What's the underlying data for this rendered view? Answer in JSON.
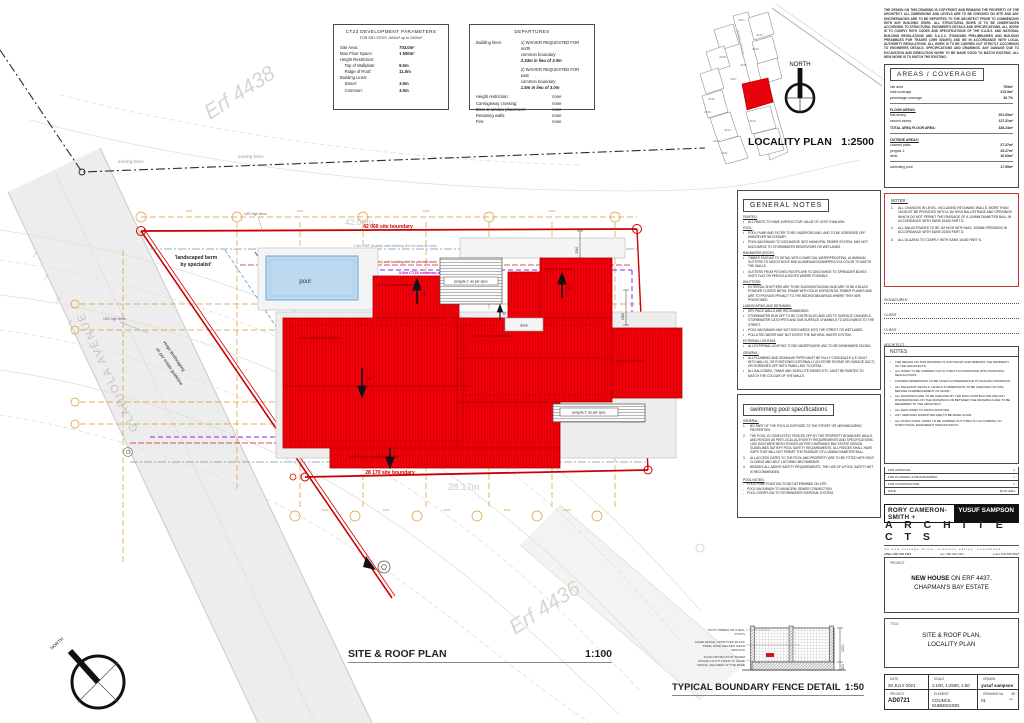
{
  "colors": {
    "roof_red": "#f2000a",
    "boundary_red": "#cc0000",
    "orange": "#d89a33",
    "purple": "#8a2bd6",
    "magenta": "#bb00bb",
    "blue_dash": "#4aa3d8",
    "pool_blue": "#bdd9ef",
    "street_gray": "#ededed",
    "notes_border": "#c0392b"
  },
  "tables": {
    "ct23": {
      "title": "CT23 DEVELOPMENT PARAMETERS",
      "subtitle": "FOR SR1 SITES >600m² up to 1000m²",
      "rows": [
        {
          "l": "Site Area:",
          "v": "703.0m²"
        },
        {
          "l": "Max Floor Space:",
          "v": "1 500m²"
        },
        {
          "l": "",
          "v": ""
        },
        {
          "l": "Height Restriction:",
          "v": ""
        },
        {
          "l": "    Top of Wallplate:",
          "v": "9.0m"
        },
        {
          "l": "    Ridge of Roof:",
          "v": "11.0m"
        },
        {
          "l": "Building Lines:",
          "v": ""
        },
        {
          "l": "    Street:",
          "v": "3.5m"
        },
        {
          "l": "    Common:",
          "v": "3.0m"
        }
      ]
    },
    "departures": {
      "title": "DEPARTURES",
      "bl_label": "Building lines:",
      "w1_lines": [
        "1) WAIVER REQUESTED FOR north",
        "common boundary"
      ],
      "w1_bold": "2.34m in lieu of 3.0m",
      "w2_lines": [
        "2) WAIVER REQUESTED FOR east",
        "common boundary"
      ],
      "w2_bold": "1.5m in lieu of 3.0m",
      "rows": [
        {
          "l": "Height restriction:",
          "v": "none"
        },
        {
          "l": "Carriageway crossing:",
          "v": "none"
        },
        {
          "l": "Door & window placement:",
          "v": "none"
        },
        {
          "l": "Retaining walls:",
          "v": "none"
        },
        {
          "l": "Fire:",
          "v": "none"
        }
      ]
    }
  },
  "locality": {
    "title": "LOCALITY PLAN",
    "scale": "1:2500",
    "north": "NORTH",
    "street": "GLADIOLA AVENUE",
    "erven": [
      "4433",
      "4435",
      "4429",
      "4438",
      "4428",
      "4437",
      "4426",
      "4440",
      "4439",
      "4434",
      "4432",
      "4431"
    ]
  },
  "copyright": "THE DESIGN ON THIS DRAWING IS COPYRIGHT AND REMAINS THE PROPERTY OF THE ARCHITECT. ALL DIMENSIONS AND LEVELS ARE TO BE CHECKED ON SITE AND ANY DISCREPANCIES ARE TO BE REPORTED TO THE ARCHITECT PRIOR TO COMMENCING WITH ANY BUILDING WORK. ALL STRUCTURAL WORK IS TO BE UNDERTAKEN ACCORDING TO STRUCTURAL ENGINEER'S DETAILS AND SPECIFICATIONS. ALL WORK IS TO COMPLY WITH CODES AND SPECIFICATIONS OF THE S.A.B.S. AND NATIONAL BUILDING REGULATIONS AND S.A.C.C. STANDARD PRELIMINARIES AND BUILDING PREAMBLES FOR TRADES (1999 ISSUES) AND BE IN ACCORDANCE WITH LOCAL AUTHORITY REGULATIONS. ALL WORK IS TO BE CARRIED OUT STRICTLY ACCORDING TO ENGINEERS DETAILS, SPECIFICATIONS AND DRAWINGS. ANY DAMAGE DUE TO EXCAVATION AND DEMOLITION WORK TO BE MADE GOOD TO MATCH EXISTING. ALL NEW WORK IS TO MATCH THE EXISTING.",
  "areas": {
    "title": "AREAS / COVERAGE",
    "g1": [
      {
        "l": "site area",
        "v": "703m²"
      },
      {
        "l": "total coverage",
        "v": "213.5m²"
      },
      {
        "l": "percentage coverage",
        "v": "30.7%"
      }
    ],
    "g2_header": "FLOOR AREAS:",
    "g2": [
      {
        "l": "first storey:",
        "v": "201.03m²"
      },
      {
        "l": "second storey:",
        "v": "127.21m²"
      }
    ],
    "g2_total": {
      "l": "TOTAL AREA FLOOR AREA:",
      "v": "328.24m²"
    },
    "g3_header": "OUTSIDE AREAS:",
    "g3": [
      {
        "l": "covered patio:",
        "v": "27.37m²"
      },
      {
        "l": "pergola 1:",
        "v": "25.27m²"
      },
      {
        "l": "deck:",
        "v": "10.63m²"
      }
    ],
    "g4": {
      "l": "swimming pool:",
      "v": "17.55m²"
    }
  },
  "general_notes": {
    "title": "GENERAL NOTES",
    "sections": [
      {
        "heading": "PAINTED:",
        "items": [
          "ALL PAINTS TO HAVE A REFLECTIVE VALUE OF LESS THAN 60%."
        ]
      },
      {
        "heading": "POOL:",
        "items": [
          "POOL PUMP AND FILTER TO BE UNDERGROUND, AND TO BE SCREENED OFF WHEREVER NECESSARY.",
          "POOL BACKWASH TO DISCHARGE INTO MUNICIPAL SEWER SYSTEM, MAY NOT DISCHARGE TO STORMWATER RESERVOIRS OR WETLANDS."
        ]
      },
      {
        "heading": "RAINWATER (ROOF):",
        "items": [
          "TIMBER FASCIAS TO DETAIL WITH CHARCOAL WATERPROOFING, ALUMINIUM GUTTERS TO MATCH ROOF AND ALUMINIUM DOWNPIPES IN A COLOR TO MATCH THE WALLS.",
          "GUTTERS FROM PITCHED ROOFS ARE TO DISCHARGE TO SPREADER BOXES ONTO FLAT OR PERGOLA ROOFS WHERE POSSIBLE."
        ]
      },
      {
        "heading": "SHUTTERS:",
        "items": [
          "EXTERNAL SHUTTERS ARE TO BE SLIDING/STACKING AND ARE TO BE A BLACK POWDER COATED METAL FRAME WITH SOLID HORIZONTAL TIMBER PLANKS AND ARE TO PROVIDE PRIVACY TO THE BEDROOMS/AREAS WHERE THEY ARE POSITIONED."
        ]
      },
      {
        "heading": "LANDSCAPING AND RETAINING:",
        "items": [
          "DRY PACK WALLS ARE RECOMMENDED.",
          "STORMWATER RUN OFF TO BE CONTROLLED AND LED TO SURFACE CHANNELS, STORMWATER CATCHPITS AND SUB SURFACE CHANNELS TO DISCHARGE TO THE STREET.",
          "POOL BACKWASH MAY NOT DISCHARGE INTO THE STREET OR WETLANDS.",
          "POLLUTED WATER MAY NOT ENTER THE NATURAL WATER SYSTEM."
        ]
      },
      {
        "heading": "EXTERNAL LIGHTING:",
        "items": [
          "ALL EXTERNAL LIGHTING TO BE UNOBTRUSIVE AND TO BE DOWNWARD FACING."
        ]
      },
      {
        "heading": "GENERAL:",
        "items": [
          "ALL PLUMBING AND DRAINAGE PIPES MUST BE FULLY CONCEALED (I.E. BUILT INTO WALLS), OR POSITIONED INTERNALLY (IN STORE ROOMS OR GARAGE DUCT) OR SCREENED OFF WITH PANELLING TO DETAIL.",
          "ALL BALCONIES, TANKS AND SATELLITE DISHES ETC. MUST BE PAINTED TO MATCH THE COLOUR OF THE WALLS."
        ]
      }
    ]
  },
  "pool_specs": {
    "title": "swimming pool specifications",
    "general_header": "GENERAL:",
    "items": [
      "NO PART OF THE POOL IS EXPOSED TO THE STREET OR NEIGHBOURING PROPERTIES.",
      "THE POOL IS COMPLETELY FENCED OFF BY THE PROPERTY BOUNDARY WALLS AND FENCES AS PER LOCAL AUTHORITY REQUIREMENTS AND SPECIFICATIONS. 1200 HIGH WIRE MESH FENCES AS PER CHAPMAN'S BAY ESTATE DESIGN GUIDELINES SATISFY POOL SAFETY REQUIREMENTS. ALL FENCES SHALL HAVE GAPS THAT WILL NOT PERMIT THE PASSAGE OF A 100MM DIAMETER BALL.",
      "ALL ACCESS GATES TO THE POOL AND PROPERTY ARE TO BE FITTED WITH SELF CLOSING AND SELF LATCHING MECHANISMS.",
      "BESIDES ALL ABOVE SAFETY REQUIREMENTS, THE USE OF A POOL SAFETY NET IS RECOMMENDED."
    ],
    "notes_header": "POOL NOTES:",
    "notes": [
      "POOL PUMP POSITION TO BE DETERMINED ON SITE.",
      "POOL BACKWASH TO MUNICIPAL SEWER CONNECTION.",
      "POOL OVERFLOW TO STORMWATER DISPOSAL SYSTEM."
    ]
  },
  "notes_red": {
    "title": "NOTES :",
    "items": [
      "ALL CHANGES IN LEVEL, INCLUDING RETAINING WALLS, MORE THAN 1M MUST BE PROVIDED WITH A 1M HIGH BALUSTRADE AND OPENINGS WHICH DO NOT PERMIT THE PASSAGE OF A 100MM DIAMETER BALL IN ACCORDANCE WITH SANS 10400 PART D.",
      "ALL BALUSTRADES TO BE 1M HIGH WITH MAX. 100MM OPENINGS IN ACCORDANCE WITH SANS 10400 PART D.",
      "ALL GLAZING TO COMPLY WITH SANS 10400 PART N."
    ]
  },
  "signatures": {
    "title": "SIGNATURES:",
    "lines": [
      "CLIENT :",
      "CLIENT :",
      "ARCHITECT :"
    ]
  },
  "notes2": {
    "title": "NOTES",
    "items": [
      "THE DESIGN ON THIS DRAWING IS COPYRIGHT AND REMAINS THE PROPERTY OF THE ARCHITECTS.",
      "ALL WORK TO BE CARRIED OUT IN STRICT ACCORDANCE WITH MUNICIPAL REGULATIONS.",
      "FIGURED DIMENSIONS TO BE TAKEN IN PREFERENCE TO SCALING DRAWINGS.",
      "ALL RELEVANT DETAILS, LEVELS & DIMENSIONS TO BE CHECKED ON SITE BEFORE COMMENCEMENT OF WORK.",
      "ALL DRAWINGS ARE TO BE CHECKED BY THE MAIN CONTRACTOR AND ANY DISCREPANCIES ON THE DRAWINGS OR BETWEEN THE DRAWINGS ARE TO BE REFERRED TO THE ARCHITECT.",
      "ALL NEW WORK TO MATCH EXISTING.",
      "ANY SERVICES DISRUPTED ARE TO BE MADE GOOD.",
      "ALL STRUCTURAL WORK TO BE CARRIED OUT STRICTLY ACCORDING TO STRUCTURAL ENGINEER'S SPECIFICATION."
    ]
  },
  "approval": {
    "rows": [
      {
        "l": "FOR APPROVAL",
        "v": "x"
      },
      {
        "l": "FOR PLANNING & PROGRAMMING",
        "v": "x"
      },
      {
        "l": "FOR CONSTRUCTION",
        "v": "x"
      },
      {
        "l": "DATE",
        "v": "20-07-2021"
      }
    ]
  },
  "architects": {
    "name_left": "RORY CAMERON-SMITH +",
    "name_right": "YUSUF SAMPSON",
    "word": "A R C H I T E C T S",
    "address": "33 sea cottage drive, crofters valley, noordhoek",
    "office": "office: 087 379 7114",
    "rory_tel": "rory: 082 426 4437",
    "yusuf_tel": "yusuf: 078 668 5823",
    "rory_reg1": "rory cameron-smith (PrArch)",
    "yusuf_reg1": "yusuf sampson (PrArch)",
    "rory_reg2": "SACAP reg no. 6784",
    "yusuf_reg2": "SACAP reg no. PST2730028",
    "rory_mail": "rory@theactive.co.za",
    "yusuf_mail": "yusufsampson@outlook.com"
  },
  "project": {
    "label": "PROJECT",
    "name_bold": "NEW HOUSE",
    "line1_rest": " ON ERF 4437,",
    "line2": "CHAPMAN'S BAY ESTATE"
  },
  "title_block": {
    "label": "TITLE",
    "line1": "SITE & ROOF PLAN,",
    "line2": "LOCALITY PLAN"
  },
  "info_table": {
    "date_label": "DATE",
    "date": "20 JULY 2021",
    "scale_label": "SCALE",
    "scale": "1:100, 1:2500, 1:50",
    "drawn_label": "DRAWN",
    "drawn": "yusuf sampson",
    "project_label": "PROJECT",
    "project_no": "AD0721",
    "element_label": "ELEMENT",
    "element": "COUNCIL SUBMISSION",
    "dwg_label": "DRAWING No",
    "dwg_no": "01",
    "rev_value": "20",
    "rev_label": "rev"
  },
  "titles": {
    "site": "SITE & ROOF PLAN",
    "site_scale": "1:100",
    "fence": "TYPICAL BOUNDARY FENCE DETAIL",
    "fence_scale": "1:50"
  },
  "site_plan": {
    "labels": {
      "boundary_top": "42 060 site boundary",
      "boundary_top_m": "42.06m",
      "boundary_bottom": "28 170 site boundary",
      "boundary_bottom_m": "28.17m",
      "boundary_right": "29 030 site boundary",
      "bl_common": "3.0m CT23 common building line",
      "bl_leanto": "1.5m CBE (estate) side building line for lean-to roofs",
      "bl_pitched": "1.5m CBE (estate) side building line for pitched roofs",
      "bl_street": "3.5m CT23 street building line",
      "berm1": "'landscaped berm",
      "berm2": "by specialist'",
      "verge1": "verge landscaping",
      "verge2": "as per estate guideline",
      "pool": "pool",
      "fence1200": "1200 high fence",
      "existing_fence": "existing fence",
      "erf_top": "Erf 4438",
      "erf_bottom": "Erf 4436",
      "north": "NORTH",
      "dim2340": "2340",
      "dim1500": "1500",
      "grid_dim": "3000",
      "roof1": "roof 1: as per specification",
      "roof2": "roof 2: as per specification",
      "roof3": "roof 3: as per specification",
      "roof4": "roof 4: as per spec",
      "roof5": "roof 5: as per spec",
      "roof6": "roof 6: as per specification",
      "pergola1": "pergola 1: as per spec",
      "pergola2": "pergola 2: as per spec",
      "deck": "deck",
      "slope75": "7.5°",
      "slope5": "5°"
    },
    "contour_labels": [
      "3.25",
      "3.50",
      "3.75",
      "4.00"
    ]
  },
  "fence_detail": {
    "l1a": "75X75 TIMBER OR STEEL",
    "l1b": "POSTS",
    "l2a": "GAME FENCE: APPROVED BLACK",
    "l2b": "STEEL WIRE WELDED MESH",
    "l2c": "FENCING",
    "l3a": "TOAD PROTECTION: 500MM",
    "l3b": "SHADE CLOTH FIXED TO GAME",
    "l3c": "FENCE, SECURED AT THE BASE",
    "dim_h": "1200",
    "dim_b": "300"
  }
}
